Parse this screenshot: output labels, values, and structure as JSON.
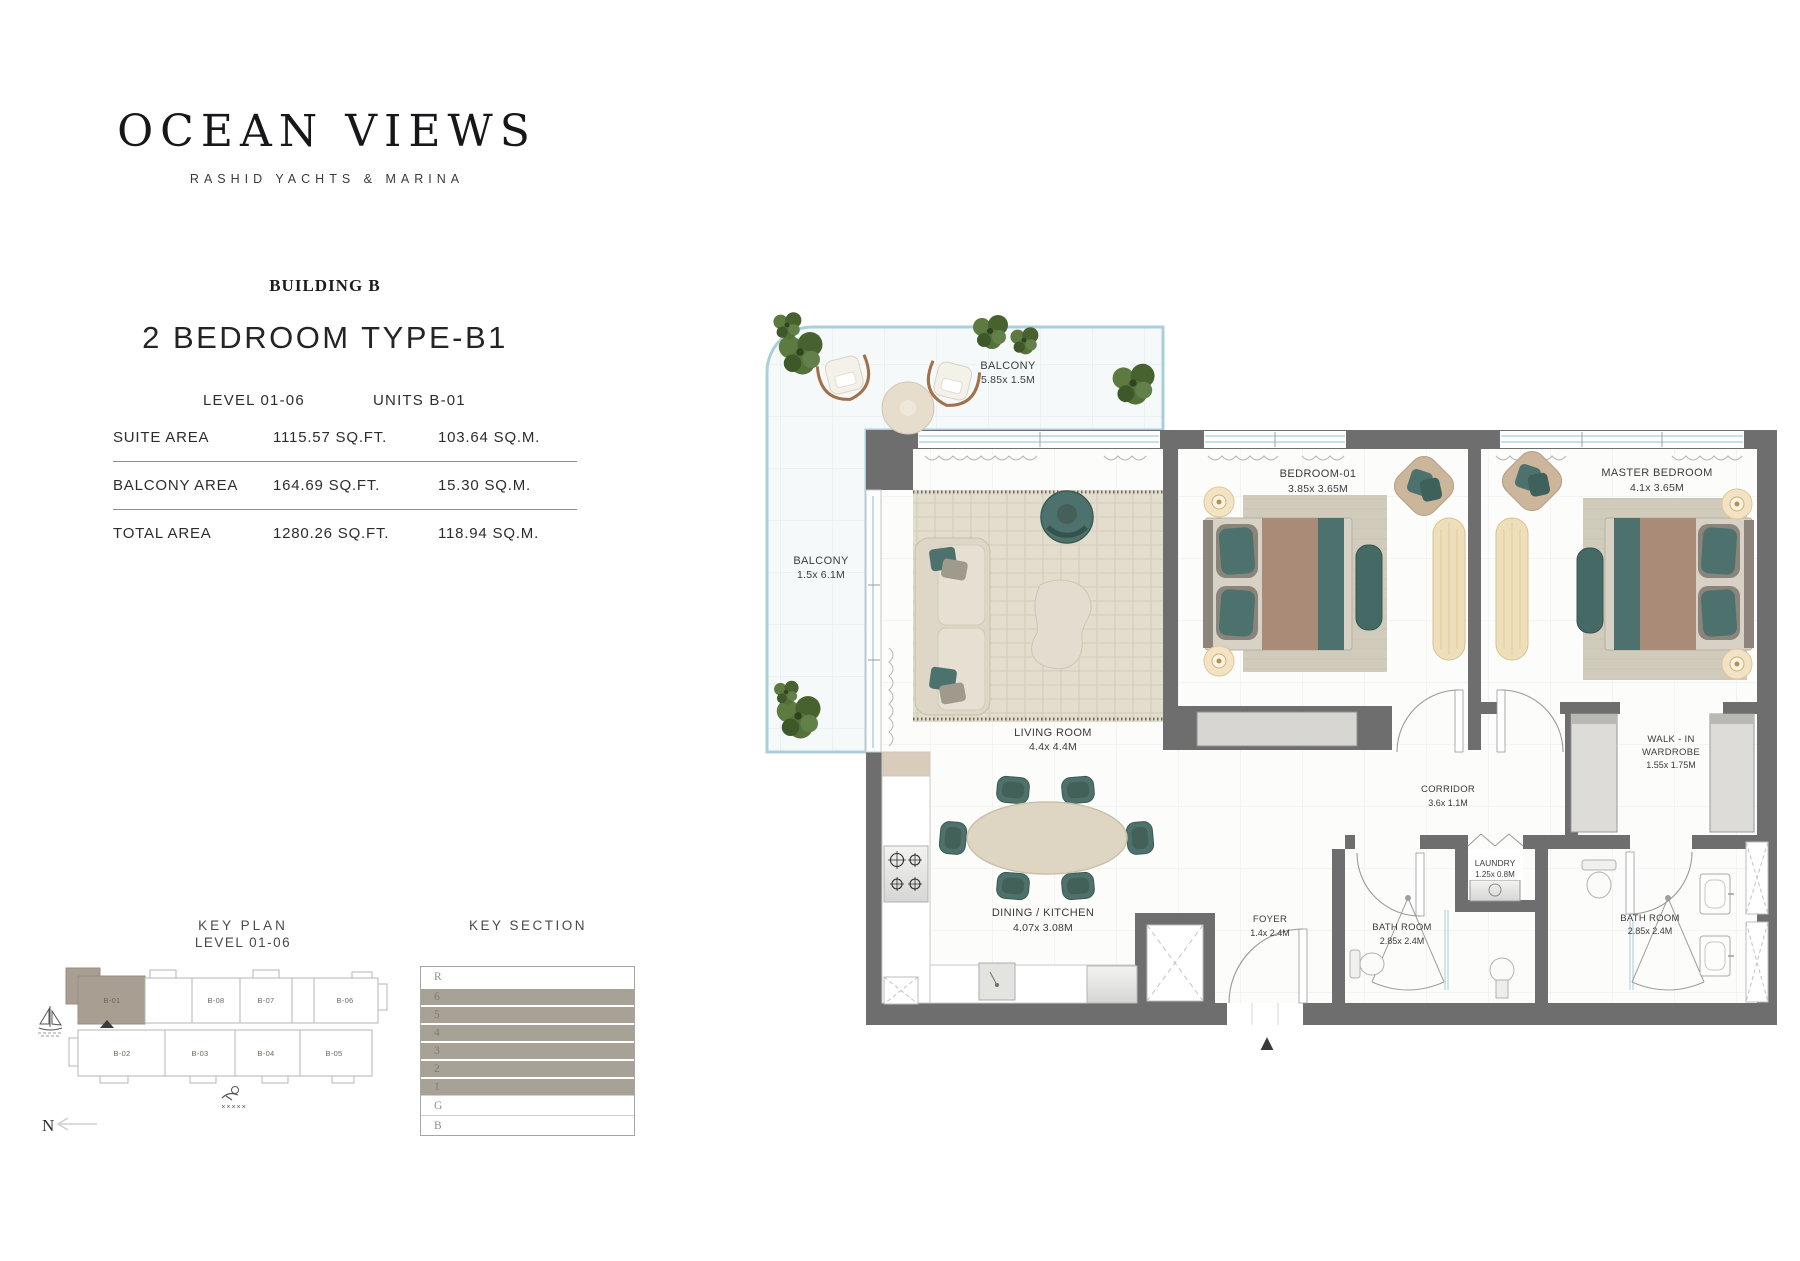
{
  "brand": {
    "logo": "OCEAN VIEWS",
    "tagline": "RASHID YACHTS & MARINA"
  },
  "header": {
    "building": "BUILDING B",
    "unit_type": "2 BEDROOM TYPE-B1",
    "level": "LEVEL 01-06",
    "units": "UNITS B-01"
  },
  "areas": {
    "rows": [
      {
        "label": "SUITE AREA",
        "sqft": "1115.57 SQ.FT.",
        "sqm": "103.64 SQ.M."
      },
      {
        "label": "BALCONY AREA",
        "sqft": "164.69  SQ.FT.",
        "sqm": "15.30  SQ.M."
      },
      {
        "label": "TOTAL AREA",
        "sqft": "1280.26 SQ.FT.",
        "sqm": "118.94 SQ.M."
      }
    ]
  },
  "key_plan": {
    "title": "KEY PLAN",
    "subtitle": "LEVEL 01-06",
    "north_label": "N",
    "highlighted_unit": "B-01",
    "highlight_color": "#a89f92",
    "units_top": [
      "B-01",
      "B-08",
      "B-07",
      "B-06"
    ],
    "units_bottom": [
      "B-02",
      "B-03",
      "B-04",
      "B-05"
    ],
    "wave_marks": "×××××"
  },
  "key_section": {
    "title": "KEY SECTION",
    "highlight_color": "#a8a195",
    "rows": [
      {
        "label": "R",
        "highlighted": false
      },
      {
        "label": "6",
        "highlighted": true
      },
      {
        "label": "5",
        "highlighted": true
      },
      {
        "label": "4",
        "highlighted": true
      },
      {
        "label": "3",
        "highlighted": true
      },
      {
        "label": "2",
        "highlighted": true
      },
      {
        "label": "1",
        "highlighted": true
      },
      {
        "label": "G",
        "highlighted": false
      },
      {
        "label": "B",
        "highlighted": false
      }
    ]
  },
  "floor_plan": {
    "colors": {
      "wall": "#6e6e6e",
      "teal_furniture": "#4d726d",
      "wood": "#eedfba",
      "rug": "#e2ddcd",
      "balcony_border": "#a9cfdc",
      "window": "#a6ccd8"
    },
    "entrance_marker": "▲",
    "rooms": {
      "balcony_top": {
        "line1": "BALCONY",
        "dims": "5.85x 1.5M"
      },
      "balcony_left": {
        "line1": "BALCONY",
        "dims": "1.5x 6.1M"
      },
      "living": {
        "line1": "LIVING ROOM",
        "dims": "4.4x 4.4M"
      },
      "bedroom1": {
        "line1": "BEDROOM-01",
        "dims": "3.85x 3.65M"
      },
      "master": {
        "line1": "MASTER BEDROOM",
        "dims": "4.1x 3.65M"
      },
      "walkin": {
        "line1": "WALK - IN",
        "line2": "WARDROBE",
        "dims": "1.55x 1.75M"
      },
      "corridor": {
        "line1": "CORRIDOR",
        "dims": "3.6x 1.1M"
      },
      "laundry": {
        "line1": "LAUNDRY",
        "dims": "1.25x 0.8M"
      },
      "dining": {
        "line1": "DINING / KITCHEN",
        "dims": "4.07x 3.08M"
      },
      "foyer": {
        "line1": "FOYER",
        "dims": "1.4x 2.4M"
      },
      "bath1": {
        "line1": "BATH ROOM",
        "dims": "2.85x 2.4M"
      },
      "bath2": {
        "line1": "BATH ROOM",
        "dims": "2.85x 2.4M"
      }
    }
  }
}
